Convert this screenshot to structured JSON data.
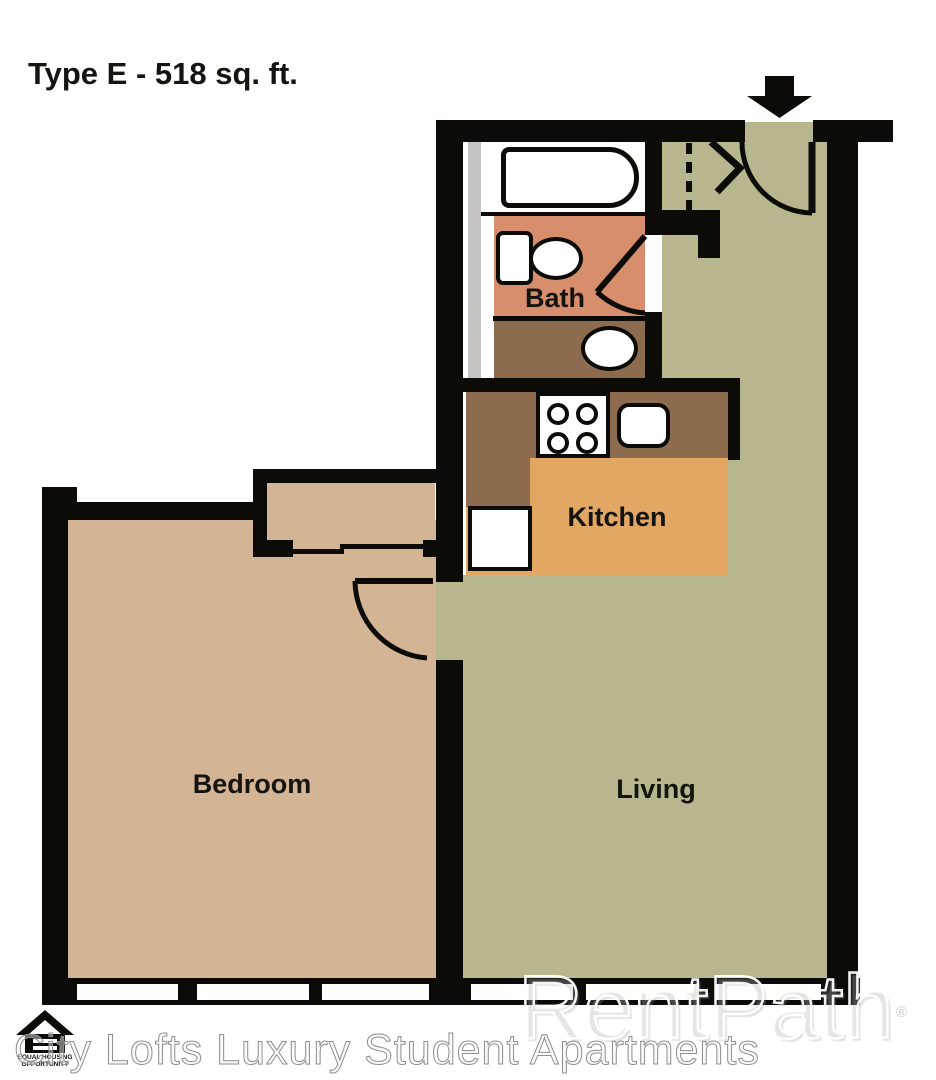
{
  "title": "Type E - 518 sq. ft.",
  "rooms": {
    "bath": "Bath",
    "kitchen": "Kitchen",
    "living": "Living",
    "bedroom": "Bedroom"
  },
  "watermark": {
    "property": "City Lofts Luxury Student Apartments",
    "brand": "RentPath",
    "registered": "®"
  },
  "equal_housing_logo": {
    "line1": "EQUAL HOUSING",
    "line2": "OPPORTUNITY"
  },
  "colors": {
    "wall": "#0c0b07",
    "living_floor": "#b8b68e",
    "bedroom_floor": "#d3b494",
    "kitchen_floor": "#e1a763",
    "counter": "#8d6b4e",
    "bath_floor": "#d68e6d",
    "plumbing_chase": "#c6c4c2",
    "fixtures": "#ffffff"
  }
}
